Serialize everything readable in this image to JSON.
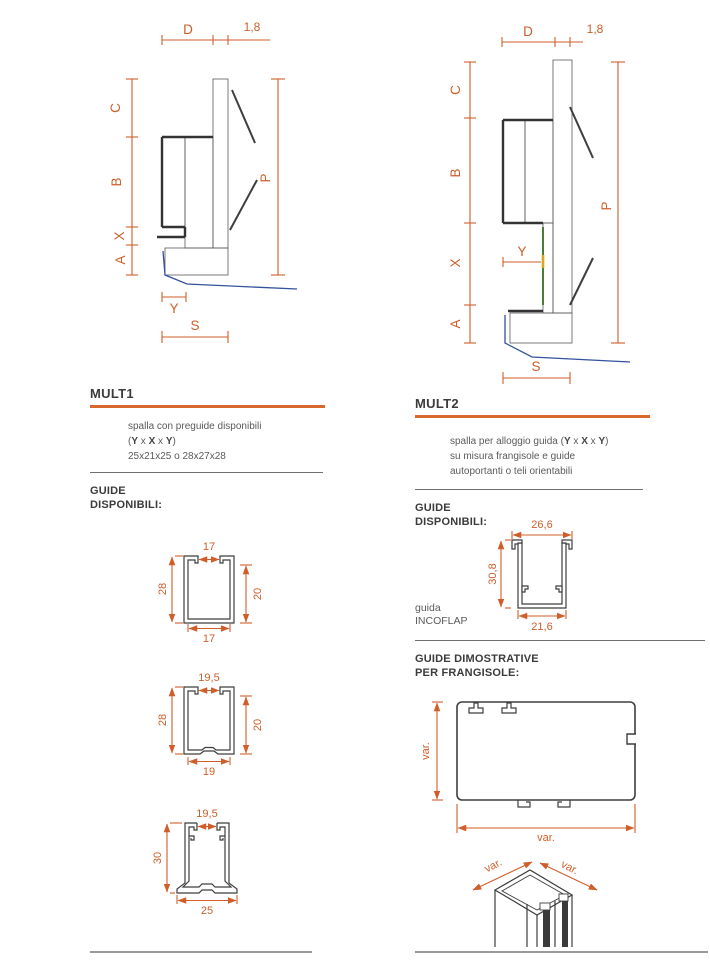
{
  "page": {
    "background": "#ffffff"
  },
  "colors": {
    "dimension": "#cf5e2a",
    "heading_rule": "#d9682c",
    "outline": "#3e3e3e",
    "wall_hatch": "#a39e96",
    "plaster_fill": "#dcc89e",
    "sill_blue": "#33519e",
    "guide_green": "#4a7d3a",
    "guide_yellow": "#d9a61f",
    "divider": "#6f6f6f",
    "footer_line": "#9a9a9a",
    "body_text": "#5a5a5a",
    "heading_text": "#3b3b3b"
  },
  "formula": {
    "open": "(",
    "y1": "Y",
    "sep1": " x ",
    "x": "X",
    "sep2": " x ",
    "y2": "Y",
    "close": ")"
  },
  "mult1": {
    "title": "MULT1",
    "desc_line1": "spalla con preguide disponibili",
    "desc_line3": "25x21x25  o  28x27x28",
    "guides_heading_line1": "GUIDE",
    "guides_heading_line2": "DISPONIBILI:",
    "diagram": {
      "d": "D",
      "coat_thickness": "1,8",
      "c": "C",
      "b": "B",
      "x": "X",
      "a": "A",
      "y": "Y",
      "s": "S",
      "p": "P"
    },
    "profiles": [
      {
        "top": "17",
        "left": "28",
        "right": "20",
        "bottom": "17"
      },
      {
        "top": "19,5",
        "left": "28",
        "right": "20",
        "bottom": "19"
      },
      {
        "top": "19,5",
        "left": "30",
        "bottom": "25"
      }
    ]
  },
  "mult2": {
    "title": "MULT2",
    "desc_line1_prefix": "spalla per alloggio guida ",
    "desc_line2": "su misura frangisole e guide",
    "desc_line3": "autoportanti o teli orientabili",
    "guides_heading_line1": "GUIDE",
    "guides_heading_line2": "DISPONIBILI:",
    "diagram": {
      "d": "D",
      "coat_thickness": "1,8",
      "c": "C",
      "b": "B",
      "x": "X",
      "a": "A",
      "y": "Y",
      "s": "S",
      "p": "P"
    },
    "incoflap": {
      "label_line1": "guida",
      "label_line2": "INCOFLAP",
      "top": "26,6",
      "left": "30,8",
      "bottom": "21,6"
    },
    "dimostrative_heading_line1": "GUIDE DIMOSTRATIVE",
    "dimostrative_heading_line2": "PER FRANGISOLE:",
    "frangisole": {
      "height": "var.",
      "width": "var."
    },
    "isometric": {
      "left": "var.",
      "right": "var."
    }
  }
}
